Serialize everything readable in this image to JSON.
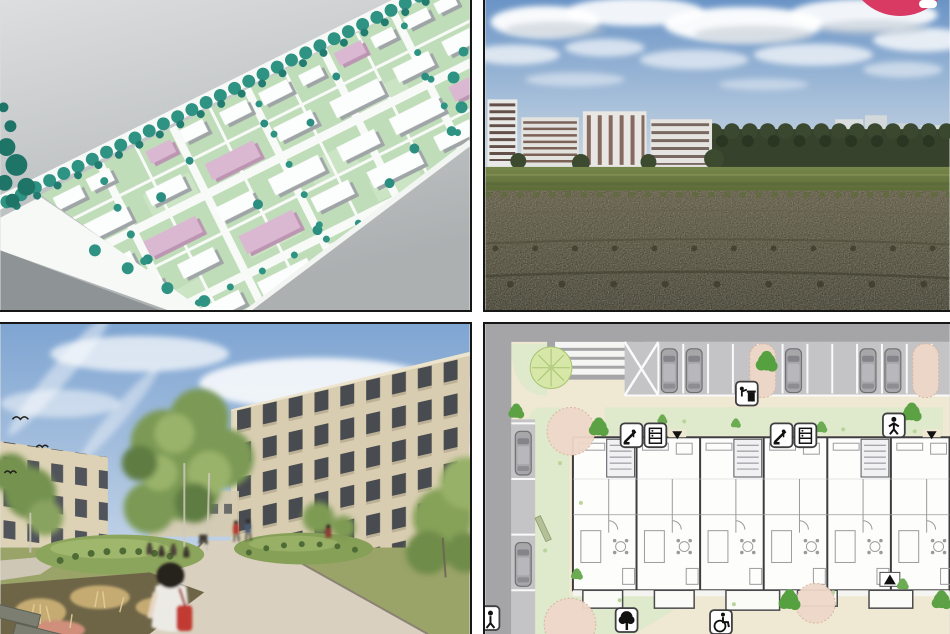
{
  "app": {
    "accent_color": "#d93a63"
  },
  "floating_button": {
    "icon": "badge-pill",
    "color": "#d93a63"
  },
  "gallery": {
    "tiles": [
      {
        "name": "3d-site-model",
        "alt": "3D massing model of a housing estate with white and pink buildings, green lawns and rows of teal trees"
      },
      {
        "name": "field-photo",
        "alt": "Open brown field with grass strip and apartment blocks on the horizon under a blue sky with clouds"
      },
      {
        "name": "courtyard-rendering",
        "alt": "Rendering of a landscaped courtyard path with people walking between new beige apartment buildings"
      },
      {
        "name": "ground-floor-site-plan",
        "alt": "Colored site plan with street parking, zebra crossing, trees, lawns and ground-floor apartment layouts"
      }
    ]
  },
  "site_plan_icons": [
    "waste-disposal-icon",
    "escalator-icon",
    "storage-shelf-icon",
    "person-icon",
    "tree-icon",
    "wheelchair-accessible-icon",
    "entrance-marker"
  ],
  "palette": {
    "frame_line": "#161616",
    "gutter": "#ffffff",
    "model_green": "#c0ddb9",
    "model_pink": "#dab8d2",
    "tree_teal": "#2f9384",
    "plan_beige": "#efe8d2",
    "plan_lawn": "#dfe9cb",
    "plan_road": "#a5a5a7",
    "accent": "#d93a63"
  }
}
